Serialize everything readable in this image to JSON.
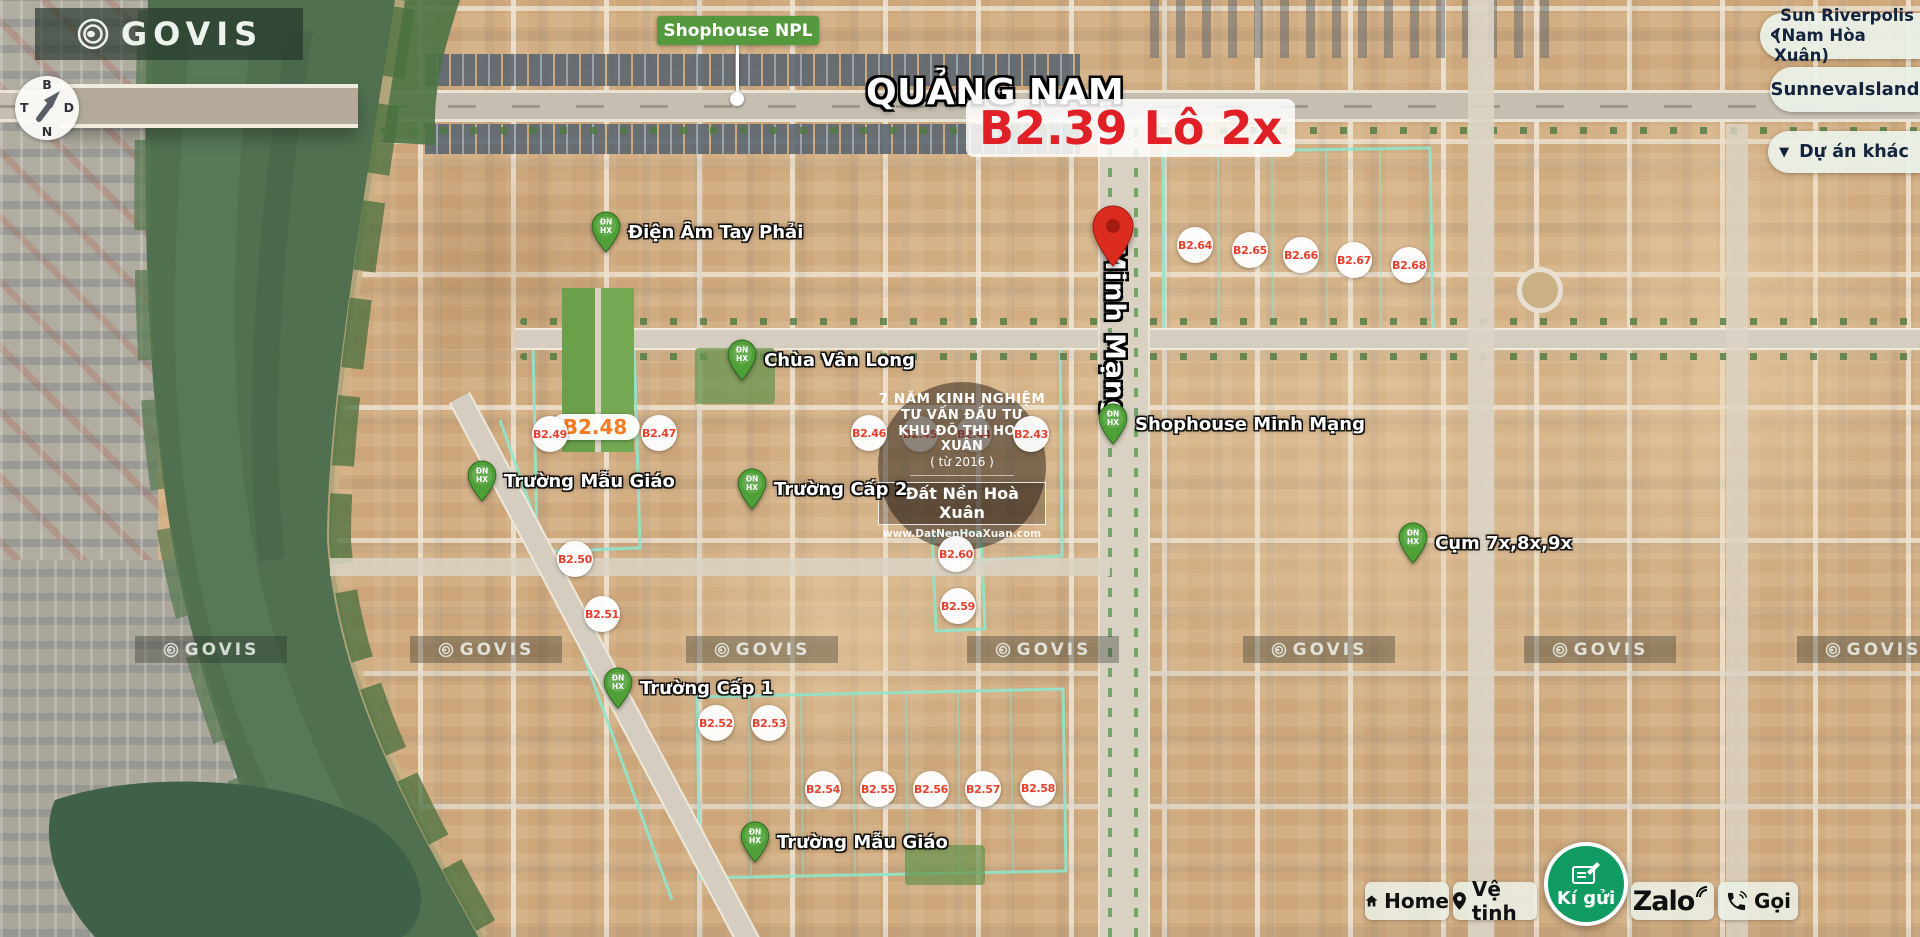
{
  "brand": {
    "logo_text": "GOVIS",
    "watermark_text": "GOVIS"
  },
  "compass": {
    "north": "B",
    "south": "N",
    "east": "D",
    "west": "T"
  },
  "icons": {
    "chevron_left": "‹",
    "chevron_down": "▼"
  },
  "callouts": {
    "shophouse_npl": "Shophouse NPL"
  },
  "headline": {
    "region": "QUẢNG NAM",
    "lot": "B2.39 Lô 2x"
  },
  "street": {
    "name": "Minh Mạng"
  },
  "experience_badge": {
    "line1": "7 NĂM KINH NGHIỆM",
    "line2": "TƯ VẤN ĐẦU TƯ",
    "line3": "KHU ĐÔ THỊ HOÀ XUÂN",
    "line4": "( từ 2016 )",
    "brand": "Đất Nền Hoà Xuân",
    "website": "www.DatNenHoaXuan.com"
  },
  "project_panel": {
    "items": [
      {
        "line1": "Sun Riverpolis",
        "line2": "(Nam Hòa Xuân)"
      },
      {
        "line1": "SunnevaIsland",
        "line2": ""
      },
      {
        "line1": "Dự án khác",
        "line2": ""
      }
    ]
  },
  "action_bar": {
    "home": "Home",
    "satellite": "Vệ tinh",
    "consign": "Kí gửi",
    "zalo": "Zalo",
    "call": "Gọi"
  },
  "highlight_pill": {
    "label": "B2.48"
  },
  "pin_monogram": {
    "line1": "ĐN",
    "line2": "HX"
  },
  "lot_markers": [
    {
      "label": "B2.43",
      "x": 1031,
      "y": 434,
      "dim": false
    },
    {
      "label": "B2.44",
      "x": 974,
      "y": 434,
      "dim": true
    },
    {
      "label": "B2.45",
      "x": 920,
      "y": 434,
      "dim": true
    },
    {
      "label": "B2.46",
      "x": 869,
      "y": 433,
      "dim": false
    },
    {
      "label": "B2.47",
      "x": 659,
      "y": 433,
      "dim": false
    },
    {
      "label": "B2.49",
      "x": 550,
      "y": 434,
      "dim": false
    },
    {
      "label": "B2.50",
      "x": 575,
      "y": 559,
      "dim": false
    },
    {
      "label": "B2.51",
      "x": 602,
      "y": 614,
      "dim": false
    },
    {
      "label": "B2.52",
      "x": 716,
      "y": 723,
      "dim": false
    },
    {
      "label": "B2.53",
      "x": 769,
      "y": 723,
      "dim": false
    },
    {
      "label": "B2.54",
      "x": 823,
      "y": 789,
      "dim": false
    },
    {
      "label": "B2.55",
      "x": 878,
      "y": 789,
      "dim": false
    },
    {
      "label": "B2.56",
      "x": 931,
      "y": 789,
      "dim": false
    },
    {
      "label": "B2.57",
      "x": 983,
      "y": 789,
      "dim": false
    },
    {
      "label": "B2.58",
      "x": 1038,
      "y": 788,
      "dim": false
    },
    {
      "label": "B2.59",
      "x": 958,
      "y": 606,
      "dim": false
    },
    {
      "label": "B2.60",
      "x": 956,
      "y": 554,
      "dim": false
    },
    {
      "label": "B2.64",
      "x": 1195,
      "y": 245,
      "dim": false
    },
    {
      "label": "B2.65",
      "x": 1250,
      "y": 250,
      "dim": false
    },
    {
      "label": "B2.66",
      "x": 1301,
      "y": 255,
      "dim": false
    },
    {
      "label": "B2.67",
      "x": 1354,
      "y": 260,
      "dim": false
    },
    {
      "label": "B2.68",
      "x": 1409,
      "y": 265,
      "dim": false
    }
  ],
  "place_markers": [
    {
      "label": "Điện Âm Tay Phải",
      "x": 606,
      "y": 232
    },
    {
      "label": "Chùa Vân Long",
      "x": 742,
      "y": 360
    },
    {
      "label": "Trường Mẫu Giáo",
      "x": 482,
      "y": 481
    },
    {
      "label": "Trường Cấp 2",
      "x": 752,
      "y": 489
    },
    {
      "label": "Shophouse Minh Mạng",
      "x": 1113,
      "y": 424
    },
    {
      "label": "Cụm 7x,8x,9x",
      "x": 1413,
      "y": 543
    },
    {
      "label": "Trường Cấp 1",
      "x": 618,
      "y": 688
    },
    {
      "label": "Trường Mẫu Giáo",
      "x": 755,
      "y": 842
    }
  ],
  "colors": {
    "headline_red": "#e01f26",
    "lot_red": "#e8402f",
    "highlight_orange": "#f47b20",
    "label_green": "#54993e",
    "pin_green": "#50a038",
    "consign_green": "#0f9b62",
    "boundary_teal": "#8fe6cd",
    "panel_text": "#15243d"
  }
}
